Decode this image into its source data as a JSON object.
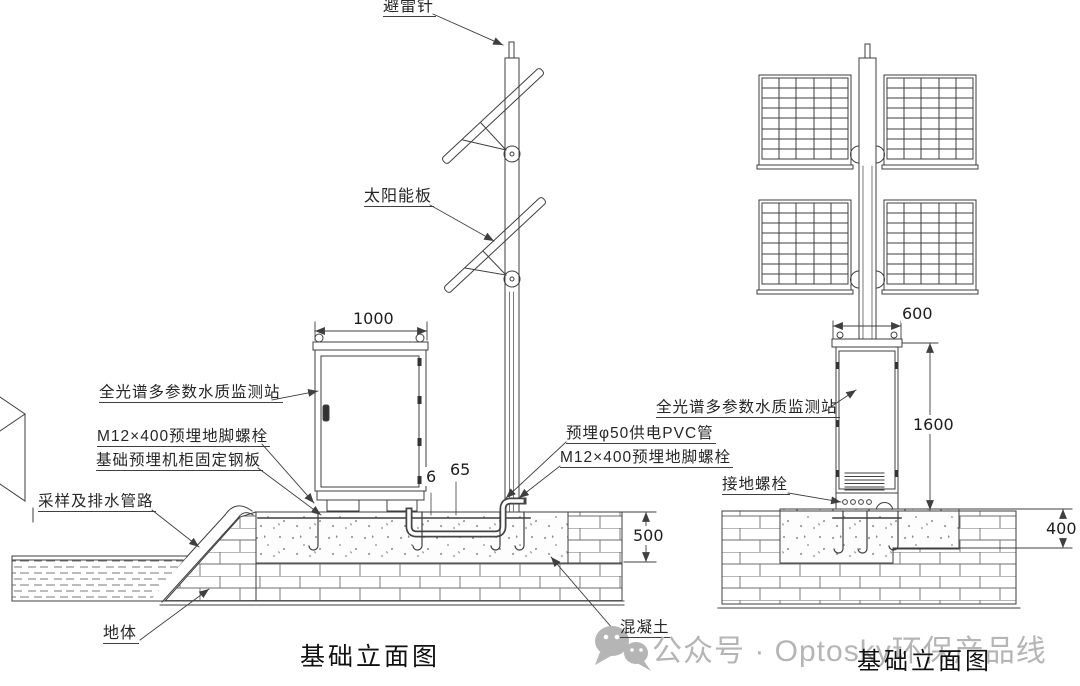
{
  "drawing": {
    "captions": {
      "left": "基础立面图",
      "right": "基础立面图"
    },
    "watermark": {
      "text": "公众号 · Optosky环保产品线"
    },
    "left_view": {
      "labels": {
        "lightning_rod": "避雷针",
        "solar_panel": "太阳能板",
        "station": "全光谱多参数水质监测站",
        "anchor_bolt": "M12×400预埋地脚螺栓",
        "steel_plate": "基础预埋机柜固定钢板",
        "sampling_drain_pipe": "采样及排水管路",
        "ground_body": "地体",
        "pvc_conduit": "预埋φ50供电PVC管",
        "anchor_bolt_2": "M12×400预埋地脚螺栓",
        "concrete": "混凝土"
      },
      "dims": {
        "cabinet_width": "1000",
        "plate_thickness": "6",
        "conduit_offset": "65",
        "foundation_depth": "500"
      }
    },
    "right_view": {
      "labels": {
        "station": "全光谱多参数水质监测站",
        "grounding_bolt": "接地螺栓"
      },
      "dims": {
        "cabinet_width": "600",
        "cabinet_height": "1600",
        "foundation_depth": "400"
      }
    },
    "colors": {
      "line": "#3f3f3f",
      "watermark": "#b5b5b5",
      "background": "#ffffff"
    }
  }
}
